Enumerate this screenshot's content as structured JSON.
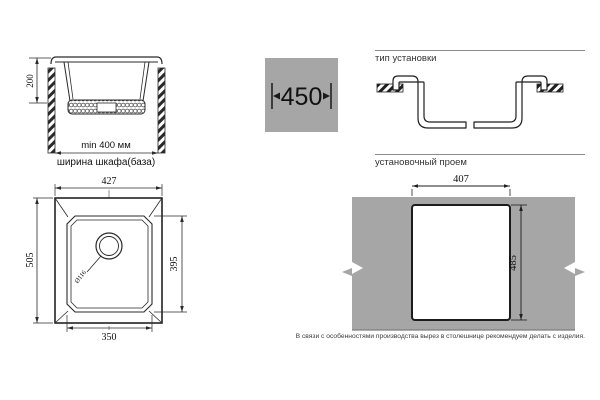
{
  "colors": {
    "countertop_gray": "#a6a6a6",
    "line": "#2a2a2a",
    "heading_text": "#333333"
  },
  "cross_section": {
    "depth": "200",
    "min_cabinet_width": "min 400 мм",
    "cabinet_width_caption": "ширина шкафа(база)"
  },
  "size_badge": {
    "overall_width": "450"
  },
  "installation_type": {
    "heading": "тип установки"
  },
  "top_view": {
    "overall_width": "427",
    "overall_depth": "505",
    "bowl_depth": "395",
    "bowl_width": "350",
    "drain_diameter": "Ø116"
  },
  "cutout": {
    "heading": "установочный проем",
    "width": "407",
    "depth": "485"
  },
  "footnote": {
    "text": "В связи с особенностями производства вырез в столешнице рекомендуем делать с изделия."
  }
}
